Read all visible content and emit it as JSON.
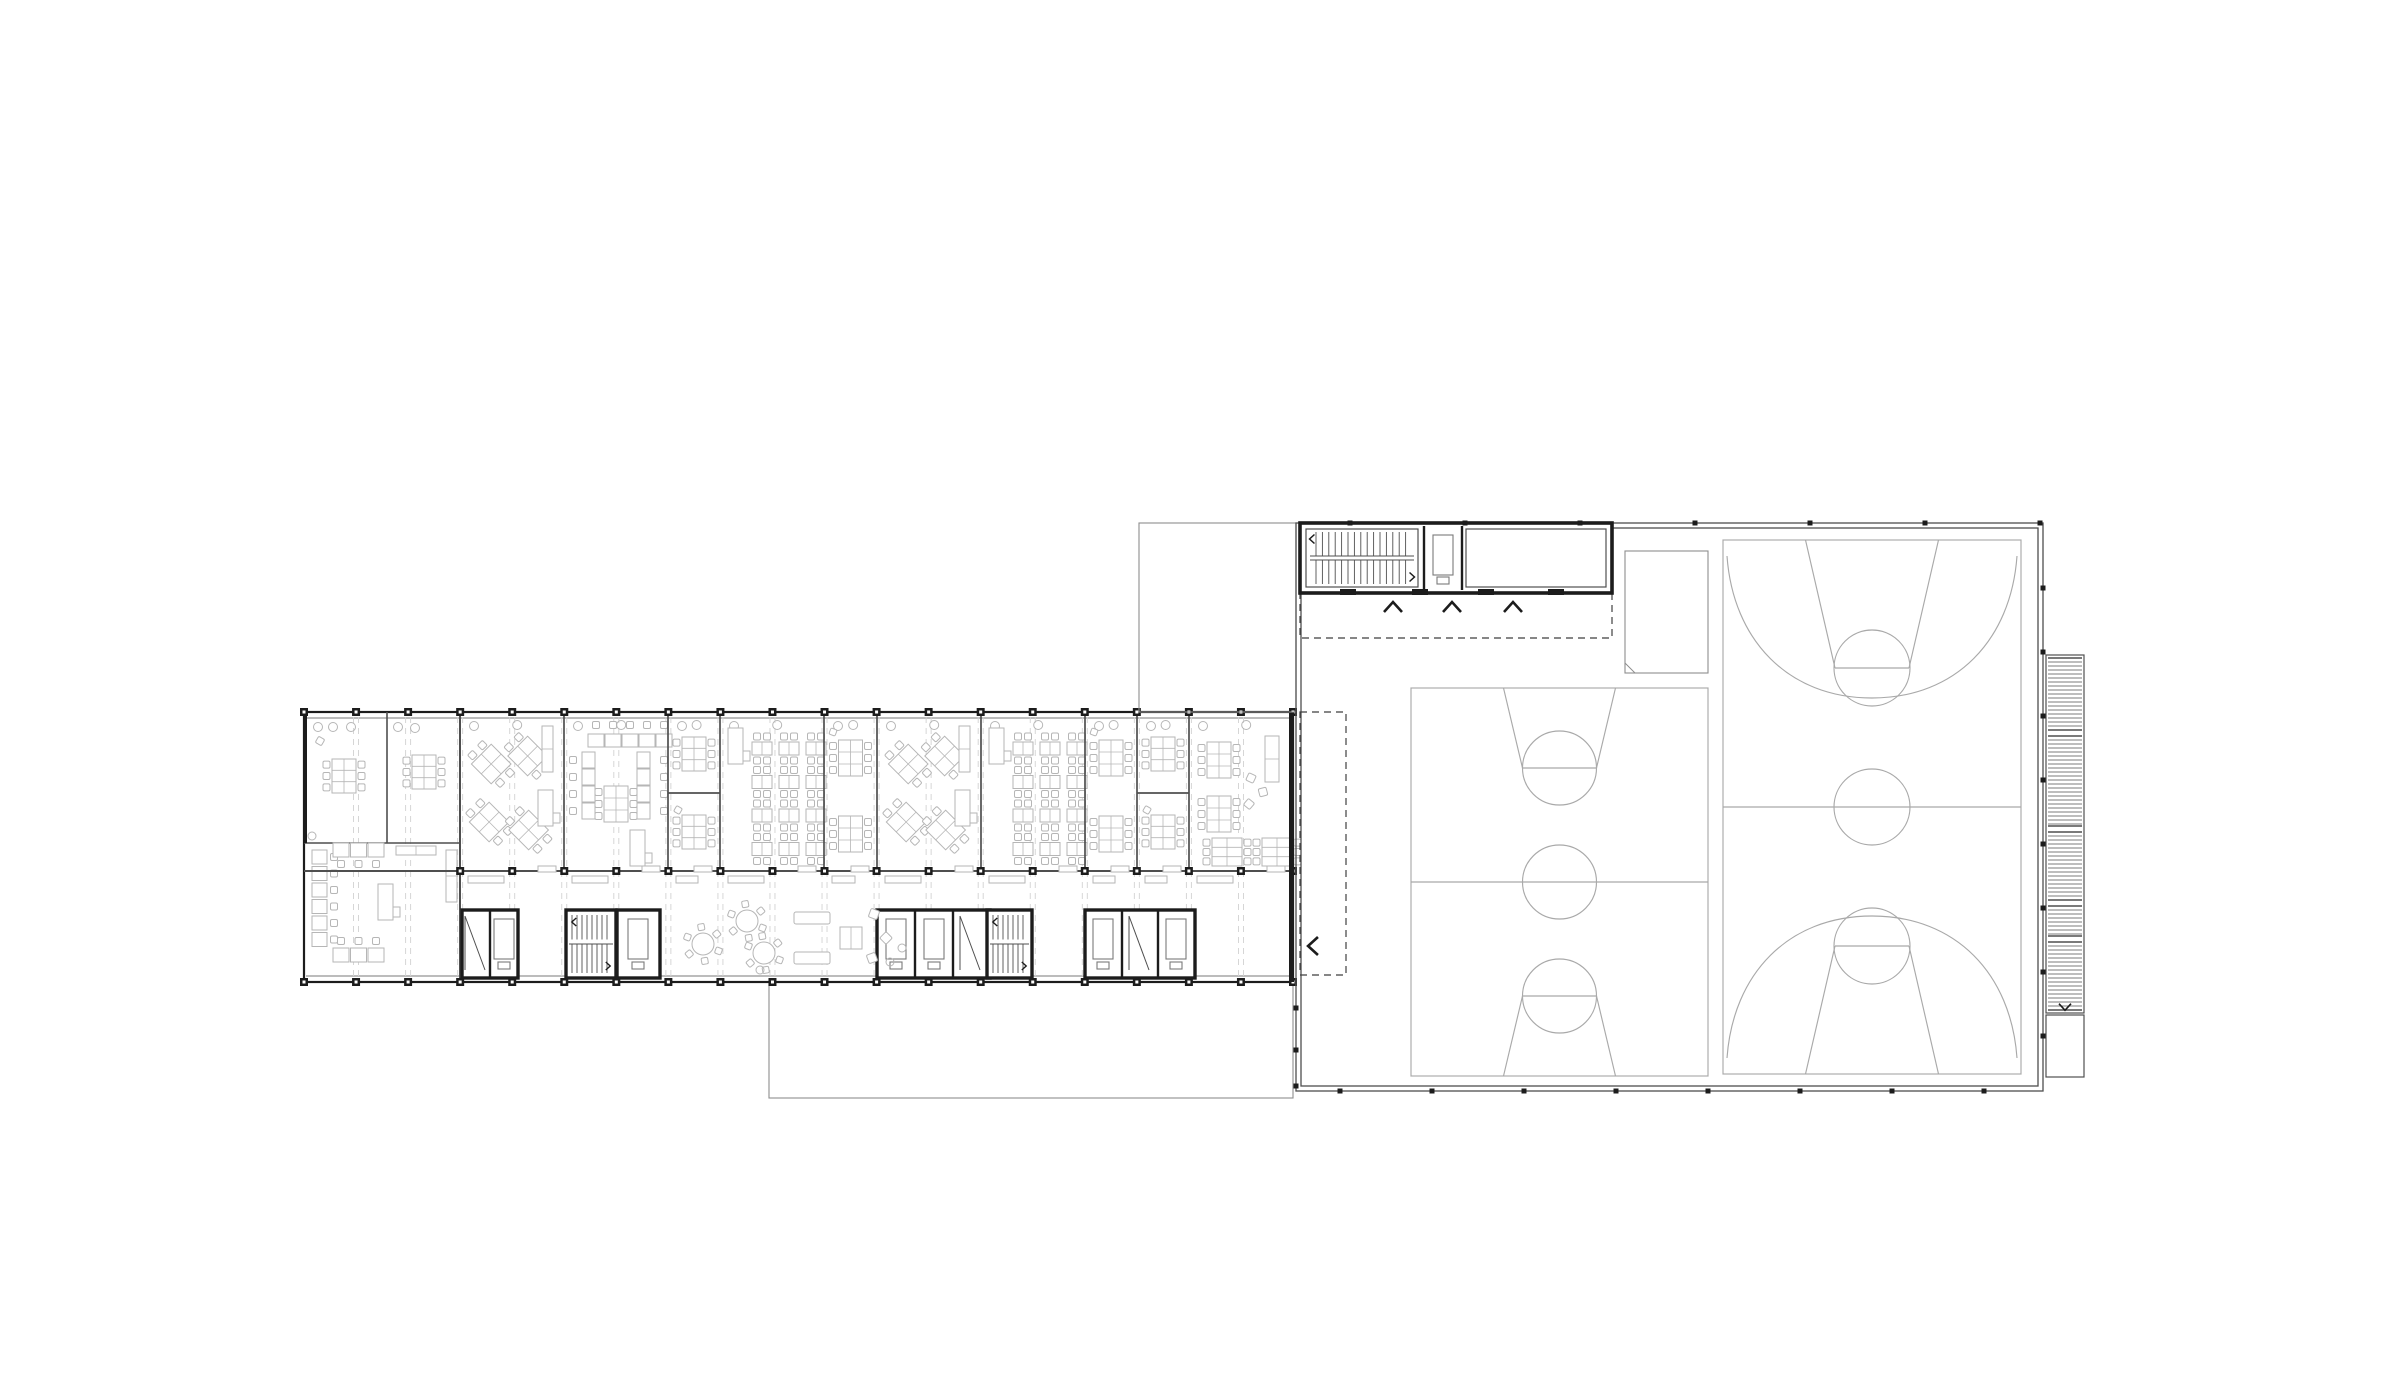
{
  "meta": {
    "description": "Architectural floor plan: classroom wing with furnished rooms and circulation cores, adjoining sports hall with two basketball courts, entry stair block and external ramp"
  },
  "colors": {
    "bg": "#ffffff",
    "wall": "#1c1c1c",
    "thin": "#4f4f4f",
    "mid": "#7a7a7a",
    "light": "#8e8e8e",
    "furn": "#b6b6b6",
    "court": "#a9a9a9",
    "axis": "#d2d2d2",
    "dash": "#3f3f3f"
  },
  "canvas": {
    "w": 2400,
    "h": 1381
  },
  "classroom_wing": {
    "bar": {
      "x": 304,
      "y": 712,
      "w": 989,
      "h": 270
    },
    "glaze_inset": 6,
    "mid_wall_y": 871,
    "sill_y": 876,
    "bays": 19,
    "left_block": {
      "divider_x": 387,
      "shelf_y": 843,
      "wall_x": 460
    },
    "rooms": [
      {
        "x": 460,
        "w": 104,
        "kind": "diamonds"
      },
      {
        "x": 564,
        "w": 104,
        "kind": "ushape"
      },
      {
        "x": 668,
        "w": 52,
        "kind": "twotables",
        "split": true
      },
      {
        "x": 720,
        "w": 104,
        "kind": "rows"
      },
      {
        "x": 824,
        "w": 53,
        "kind": "twotables"
      },
      {
        "x": 877,
        "w": 104,
        "kind": "diamonds"
      },
      {
        "x": 981,
        "w": 104,
        "kind": "rows"
      },
      {
        "x": 1085,
        "w": 52,
        "kind": "twotables"
      },
      {
        "x": 1137,
        "w": 52,
        "kind": "twotables",
        "split": true
      },
      {
        "x": 1189,
        "w": 104,
        "kind": "groups"
      }
    ],
    "cores": [
      {
        "type": "elev",
        "x": 462,
        "y": 910,
        "w": 56,
        "h": 68,
        "divs": [
          490
        ],
        "boxes": [
          504
        ],
        "slashes": [
          476
        ]
      },
      {
        "type": "stair",
        "x": 566,
        "y": 910,
        "w": 50,
        "h": 68
      },
      {
        "type": "elev",
        "x": 617,
        "y": 910,
        "w": 43,
        "h": 68,
        "divs": [],
        "boxes": [
          638
        ],
        "slashes": []
      },
      {
        "type": "elev",
        "x": 877,
        "y": 910,
        "w": 113,
        "h": 68,
        "divs": [
          915,
          953
        ],
        "boxes": [
          896,
          934
        ],
        "slashes": [
          971
        ]
      },
      {
        "type": "stair",
        "x": 987,
        "y": 910,
        "w": 45,
        "h": 68
      },
      {
        "type": "elev",
        "x": 1085,
        "y": 910,
        "w": 110,
        "h": 68,
        "divs": [
          1122,
          1158
        ],
        "boxes": [
          1103,
          1176
        ],
        "slashes": [
          1140
        ]
      }
    ],
    "lounge": {
      "tables": [
        [
          703,
          944
        ],
        [
          747,
          921
        ],
        [
          764,
          953
        ]
      ],
      "sofas": [
        [
          794,
          912
        ],
        [
          794,
          952
        ]
      ],
      "sofa_w": 36,
      "table_sq": [
        840,
        927,
        22
      ],
      "poufs": [
        [
          874,
          914
        ],
        [
          886,
          938
        ],
        [
          872,
          958
        ]
      ],
      "dots": [
        [
          760,
          970
        ],
        [
          890,
          962
        ],
        [
          902,
          948
        ]
      ]
    },
    "terrace": {
      "x": 769,
      "y": 982,
      "w": 524,
      "h": 116
    }
  },
  "sports_hall": {
    "outer": {
      "x": 1296,
      "y": 523,
      "w": 747,
      "h": 568
    },
    "inset": 5,
    "courtyard": {
      "x": 1139,
      "y": 523,
      "w": 157,
      "h": 189
    },
    "stair_block": {
      "x": 1300,
      "y": 523,
      "w": 312,
      "h": 70,
      "stair_x2": 1424,
      "shaft_x2": 1462,
      "tread_x1": 1316,
      "tread_x2": 1408,
      "tread_step": 6.4,
      "ticks": [
        1348,
        1420,
        1486,
        1556
      ]
    },
    "dashed_rects": [
      {
        "x": 1300,
        "y": 593,
        "w": 312,
        "h": 45
      },
      {
        "x": 1300,
        "y": 712,
        "w": 46,
        "h": 263
      }
    ],
    "chevrons_up": [
      [
        1393,
        607
      ],
      [
        1452,
        607
      ],
      [
        1513,
        607
      ]
    ],
    "chevron_left": [
      1313,
      946
    ],
    "equipment_room": {
      "x": 1625,
      "y": 551,
      "w": 83,
      "h": 122
    },
    "courts": [
      {
        "x": 1411,
        "y": 688,
        "w": 297,
        "h": 388,
        "laneTop": 112,
        "laneBot": 74,
        "ftD": 80,
        "ftR": 37,
        "centerR": 37,
        "three": false
      },
      {
        "x": 1723,
        "y": 540,
        "w": 298,
        "h": 534,
        "laneTop": 133,
        "laneBot": 74,
        "ftD": 128,
        "ftR": 38,
        "centerR": 38,
        "three": true,
        "threeDepth": 158
      }
    ],
    "ramp": {
      "x": 2046,
      "y": 655,
      "w": 38,
      "segments": [
        [
          658,
          730
        ],
        [
          736,
          826
        ],
        [
          832,
          900
        ],
        [
          906,
          936
        ],
        [
          942,
          1010
        ]
      ],
      "box_y": 1015,
      "box_h": 62,
      "chevron": [
        2065,
        1007
      ]
    },
    "edge_dots": {
      "top": {
        "y": 523,
        "xs": [
          1350,
          1465,
          1580,
          1695,
          1810,
          1925,
          2040
        ]
      },
      "right": {
        "x": 2043,
        "ys": [
          588,
          652,
          716,
          780,
          844,
          908,
          972,
          1036
        ]
      },
      "bottom": {
        "y": 1091,
        "xs": [
          1340,
          1432,
          1524,
          1616,
          1708,
          1800,
          1892,
          1984
        ]
      },
      "left": {
        "x": 1296,
        "ys": [
          1008,
          1050,
          1086
        ]
      }
    }
  }
}
